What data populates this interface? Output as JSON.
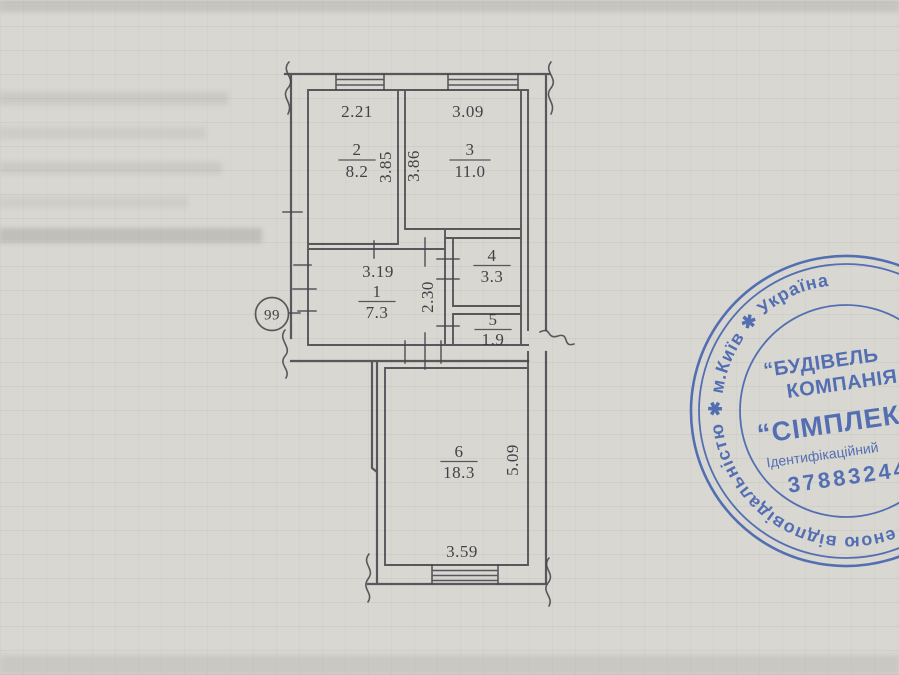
{
  "plan": {
    "ink_color": "#45464b",
    "text_color": "#34353b",
    "apartment_number": "99",
    "rooms": [
      {
        "number": "1",
        "area": "7.3"
      },
      {
        "number": "2",
        "area": "8.2"
      },
      {
        "number": "3",
        "area": "11.0"
      },
      {
        "number": "4",
        "area": "3.3"
      },
      {
        "number": "5",
        "area": "1.9"
      },
      {
        "number": "6",
        "area": "18.3"
      }
    ],
    "dimensions": {
      "room2_width": "2.21",
      "room3_width": "3.09",
      "room2_depth": "3.85",
      "room3_depth": "3.86",
      "hall_width": "3.19",
      "hall_depth": "2.30",
      "room6_depth": "5.09",
      "room6_width": "3.59"
    }
  },
  "stamp": {
    "color": "#3a5cad",
    "ring_text": "еною відповідальністю ✱ м.Київ ✱ Україна",
    "org_prefix": "“БУДІВЕЛЬ",
    "org_word": "КОМПАНІЯ",
    "company_name": "“СІМПЛЕКС-С",
    "id_label": "Ідентифікаційний",
    "id_number": "37883244"
  }
}
